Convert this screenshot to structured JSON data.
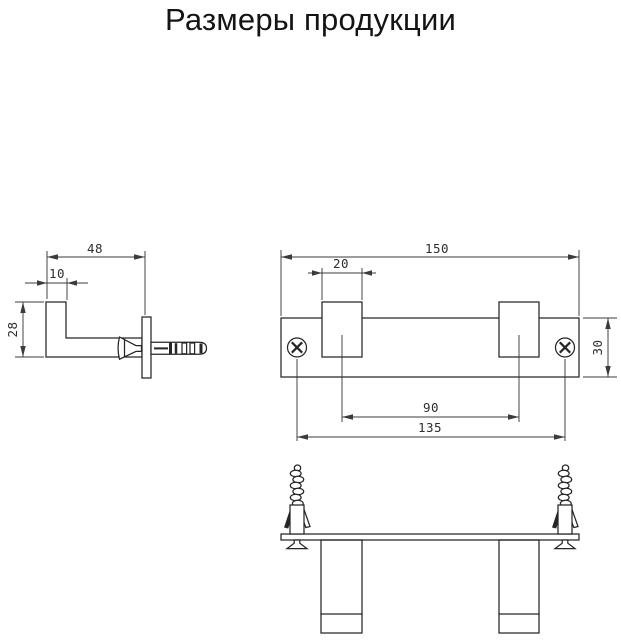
{
  "title": "Размеры продукции",
  "colors": {
    "background": "#ffffff",
    "part_line": "#262626",
    "dimension_line": "#3b3b3b",
    "label_text": "#2e2e2e",
    "title_text": "#141414"
  },
  "side_view": {
    "depth": "48",
    "hook_width": "10",
    "height": "28"
  },
  "front_view": {
    "length": "150",
    "hook_width": "20",
    "height": "30",
    "hook_spacing": "90",
    "screw_spacing": "135"
  }
}
